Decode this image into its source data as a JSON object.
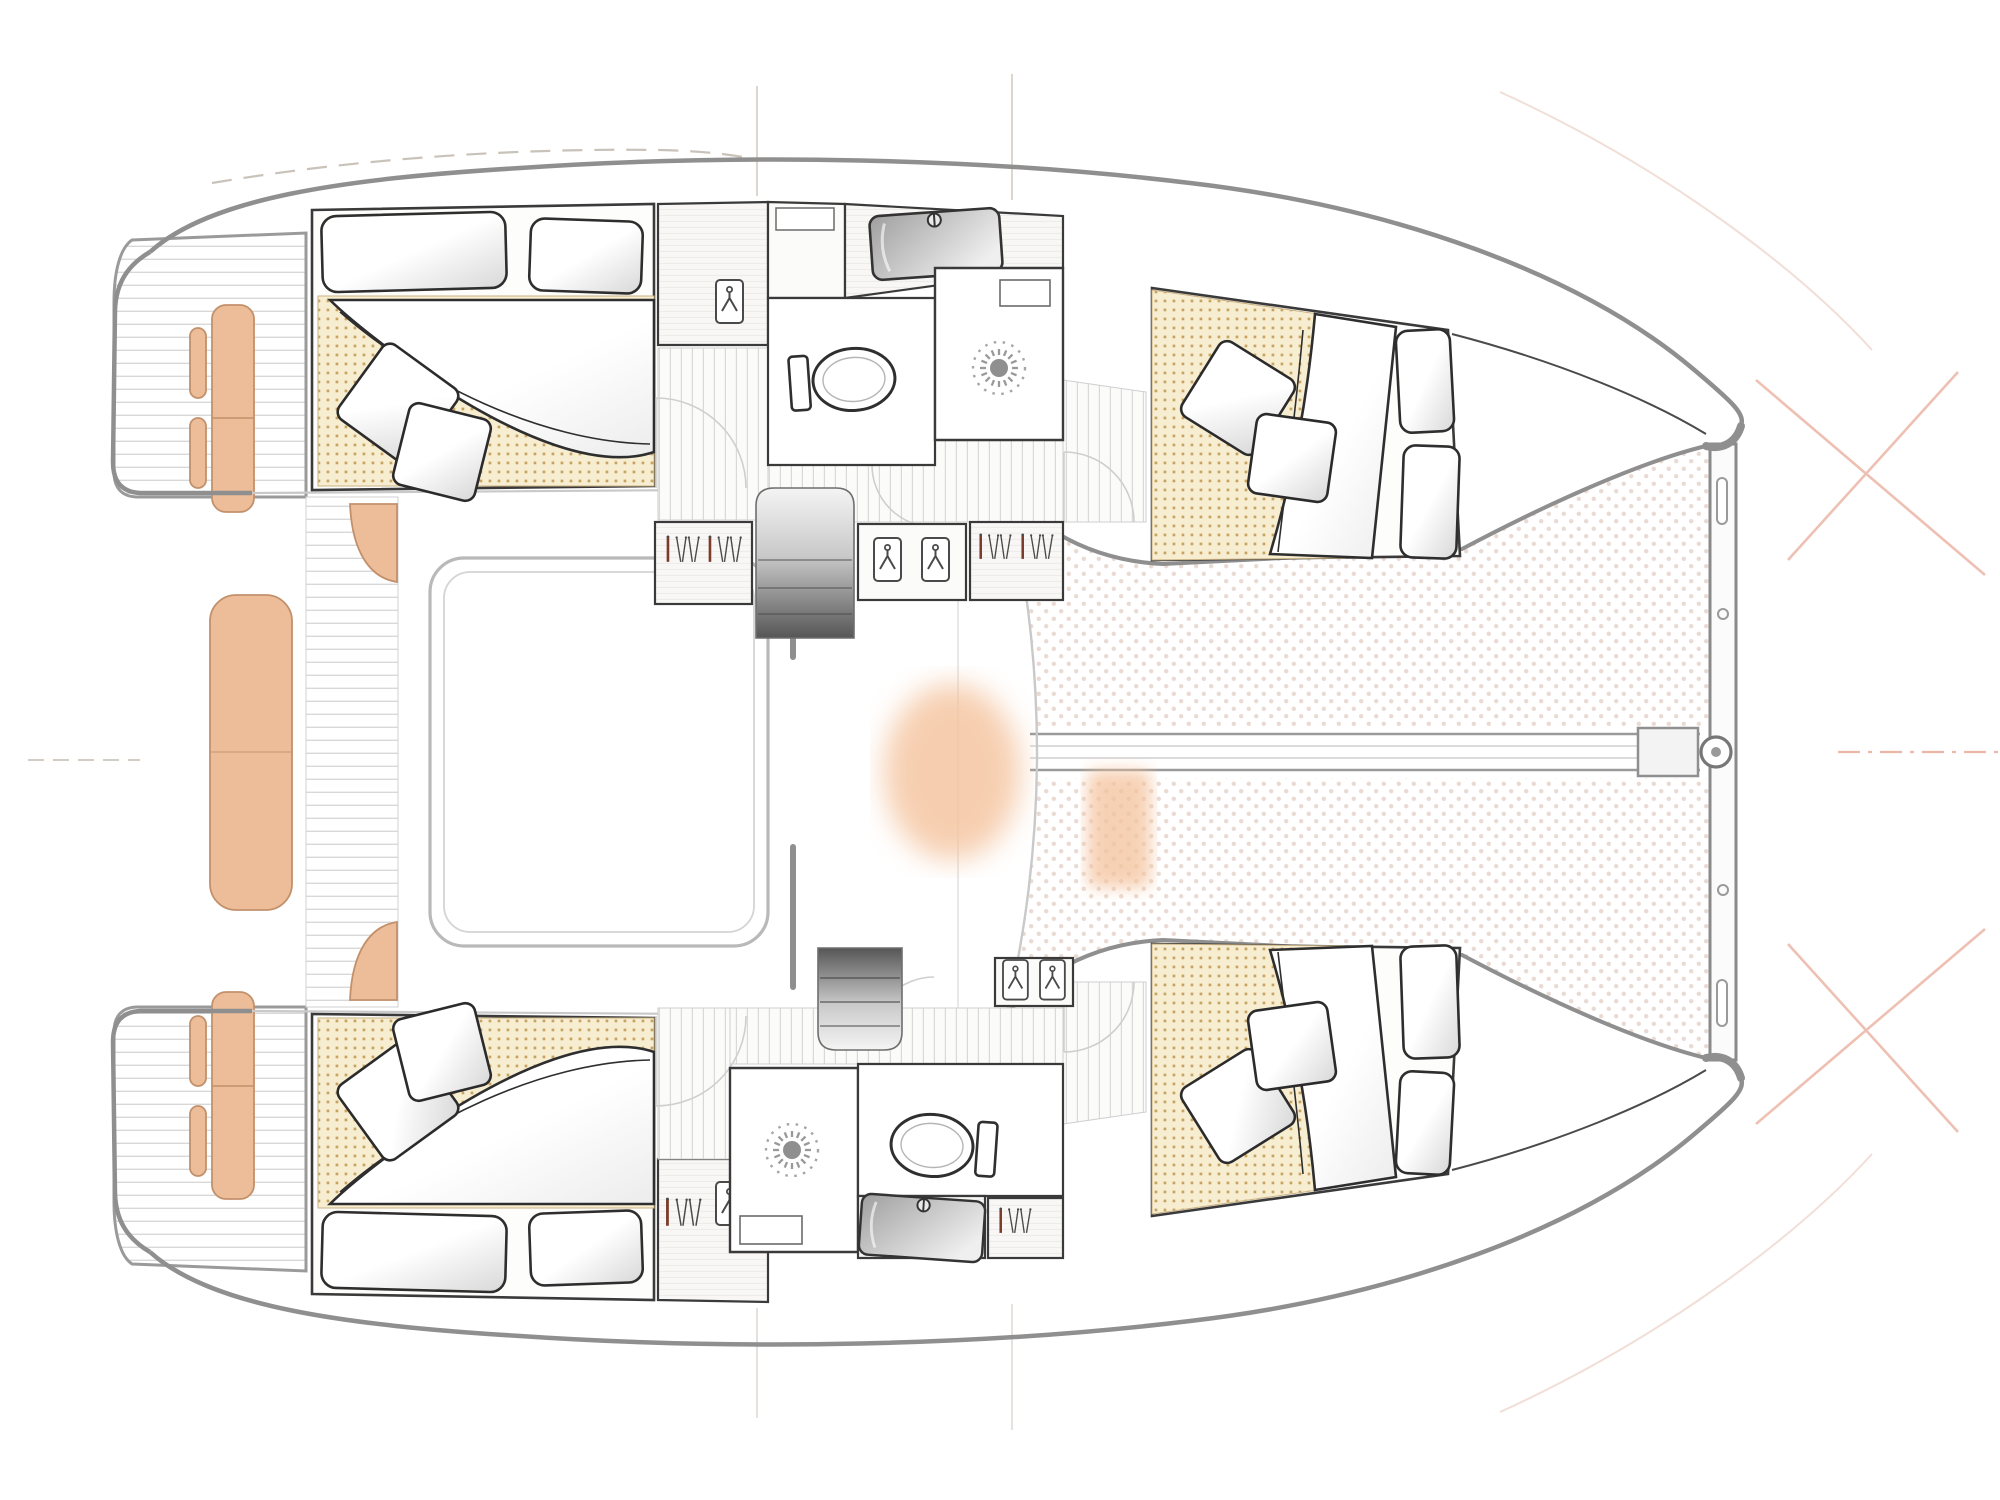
{
  "page": {
    "title": "Catamaran interior floor plan — top-down deck view",
    "background": "#ffffff"
  },
  "colors": {
    "background": "#ffffff",
    "hull_outline": "#8f8f8f",
    "deck_line": "#c9c9c9",
    "room_outline": "#3a3a3a",
    "plank_line": "#d8d8d8",
    "mattress_bg": "#f7eed2",
    "mattress_dot": "#c8a360",
    "trampoline_dot": "#e9dbd3",
    "cushion_fill": "#ecbd98",
    "cushion_outline": "#c2916c",
    "glow": "#f4c29c",
    "steps_dark": "#565656",
    "hanger_accent": "#7a3b2a",
    "icon_stroke": "#4a4a4a",
    "pillow_stroke": "#2e2e2e",
    "construction_salmon": "#ecb6a6",
    "construction_gray": "#c9c2ba"
  },
  "vessel": {
    "type": "catamaran",
    "view": "interior layout plan, bow to the right, stern to the left",
    "hulls": [
      {
        "id": "port-hull-top",
        "aft_cabin": {
          "bed": "double",
          "head_pillows": 2,
          "scatter_pillows": 2,
          "duvet": true,
          "mattress_pattern": "tan dot grid"
        },
        "forward_cabin": {
          "bed": "double",
          "head_pillows": 2,
          "scatter_pillows": 2,
          "duvet": true,
          "mattress_pattern": "tan dot grid"
        },
        "bathroom": {
          "sink": 1,
          "toilet": 1,
          "shower": 1,
          "shower_symbol": "sunburst"
        },
        "wardrobes_with_hangers": 3,
        "hanging_lockers": 3,
        "companionway_steps": 1
      },
      {
        "id": "starboard-hull-bottom",
        "aft_cabin": {
          "bed": "double",
          "head_pillows": 2,
          "scatter_pillows": 2,
          "duvet": true,
          "mattress_pattern": "tan dot grid"
        },
        "forward_cabin": {
          "bed": "double",
          "head_pillows": 2,
          "scatter_pillows": 2,
          "duvet": true,
          "mattress_pattern": "tan dot grid"
        },
        "bathroom": {
          "sink": 1,
          "toilet": 1,
          "shower": 1,
          "shower_symbol": "sunburst"
        },
        "wardrobes_with_hangers": 2,
        "hanging_lockers": 3,
        "companionway_steps": 1
      }
    ],
    "deck": {
      "swim_platforms": 2,
      "cockpit": {
        "transom_bench_cushions": 2,
        "center_bench_cushion": 1,
        "small_seat_pads": 4,
        "corner_seats": 2,
        "seating_frame": true
      },
      "saloon": "open bridgedeck, undetailed (white)",
      "trampoline": {
        "present": true,
        "pattern": "diagonal dot mesh"
      },
      "crossbeam": true,
      "bowsprit_centerline": true,
      "forestay_fitting": true
    },
    "annotations": {
      "text_labels": [],
      "construction_lines": [
        "dashed sheer guide top-left",
        "short vertical station ticks top and bottom center",
        "salmon cross marks at bow centerlines",
        "salmon dash-dot centerline at far right",
        "faint diagonal sheer guides upper-right and lower-right"
      ]
    }
  },
  "icons": {
    "hangers-icon": "row of clothes hangers (one accent-colored)",
    "hanging-locker-icon": "single hanger inside locker",
    "sunburst-icon": "shower ceiling fitting",
    "toilet-icon": "toilet bowl with cistern",
    "sink-icon": "washbasin with tap",
    "steps-icon": "companionway stairs (gradient)"
  }
}
